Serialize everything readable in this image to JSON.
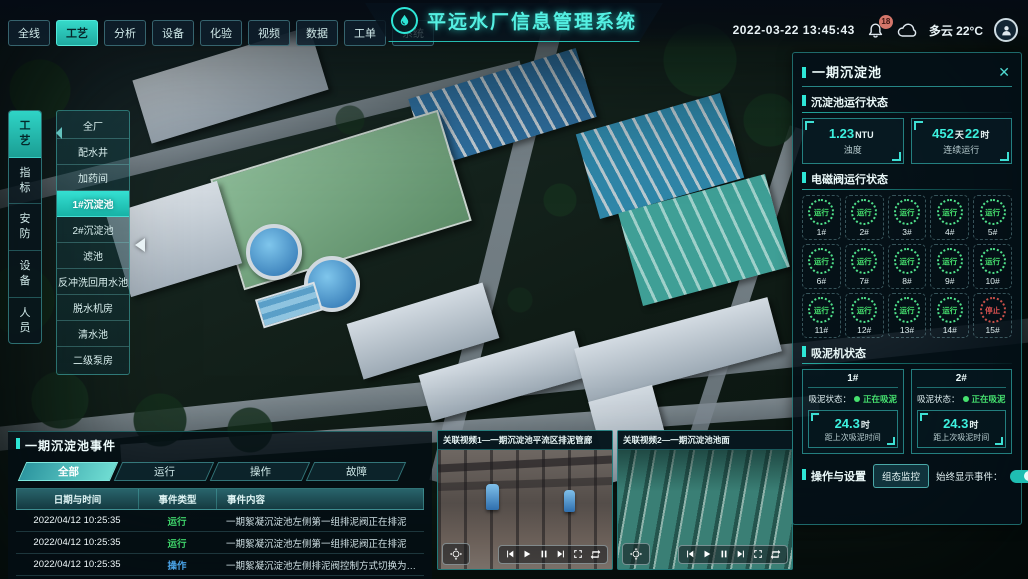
{
  "app": {
    "title": "平远水厂信息管理系统",
    "datetime": "2022-03-22 13:45:43",
    "notification_count": "18",
    "weather": "多云 22°C"
  },
  "nav_tabs": [
    {
      "label": "全线",
      "state": ""
    },
    {
      "label": "工艺",
      "state": "active"
    },
    {
      "label": "分析",
      "state": ""
    },
    {
      "label": "设备",
      "state": ""
    },
    {
      "label": "化验",
      "state": ""
    },
    {
      "label": "视频",
      "state": ""
    },
    {
      "label": "数据",
      "state": ""
    },
    {
      "label": "工单",
      "state": ""
    },
    {
      "label": "系统",
      "state": ""
    }
  ],
  "side_tabs": [
    {
      "label": "工艺",
      "state": "active"
    },
    {
      "label": "指标",
      "state": ""
    },
    {
      "label": "安防",
      "state": ""
    },
    {
      "label": "设备",
      "state": ""
    },
    {
      "label": "人员",
      "state": ""
    }
  ],
  "process_menu": [
    {
      "label": "全厂",
      "state": ""
    },
    {
      "label": "配水井",
      "state": ""
    },
    {
      "label": "加药间",
      "state": ""
    },
    {
      "label": "1#沉淀池",
      "state": "active"
    },
    {
      "label": "2#沉淀池",
      "state": ""
    },
    {
      "label": "滤池",
      "state": ""
    },
    {
      "label": "反冲洗回用水池",
      "state": ""
    },
    {
      "label": "脱水机房",
      "state": ""
    },
    {
      "label": "清水池",
      "state": ""
    },
    {
      "label": "二级泵房",
      "state": ""
    }
  ],
  "right_panel": {
    "title": "一期沉淀池",
    "run_status": {
      "title": "沉淀池运行状态",
      "stats": [
        {
          "value": "1.23",
          "unit": "NTU",
          "label": "浊度"
        },
        {
          "value": "452",
          "unit": "天",
          "value2": "22",
          "unit2": "时",
          "label": "连续运行"
        }
      ]
    },
    "valves": {
      "title": "电磁阀运行状态",
      "items": [
        {
          "id": "1#",
          "status": "运行",
          "state": "run"
        },
        {
          "id": "2#",
          "status": "运行",
          "state": "run"
        },
        {
          "id": "3#",
          "status": "运行",
          "state": "run"
        },
        {
          "id": "4#",
          "status": "运行",
          "state": "run"
        },
        {
          "id": "5#",
          "status": "运行",
          "state": "run"
        },
        {
          "id": "6#",
          "status": "运行",
          "state": "run"
        },
        {
          "id": "7#",
          "status": "运行",
          "state": "run"
        },
        {
          "id": "8#",
          "status": "运行",
          "state": "run"
        },
        {
          "id": "9#",
          "status": "运行",
          "state": "run"
        },
        {
          "id": "10#",
          "status": "运行",
          "state": "run"
        },
        {
          "id": "11#",
          "status": "运行",
          "state": "run"
        },
        {
          "id": "12#",
          "status": "运行",
          "state": "run"
        },
        {
          "id": "13#",
          "status": "运行",
          "state": "run"
        },
        {
          "id": "14#",
          "status": "运行",
          "state": "run"
        },
        {
          "id": "15#",
          "status": "停止",
          "state": "stop"
        }
      ]
    },
    "mud": {
      "title": "吸泥机状态",
      "status_label": "吸泥状态：",
      "items": [
        {
          "id": "1#",
          "status": "正在吸泥",
          "value": "24.3",
          "unit": "时",
          "label": "距上次吸泥时间"
        },
        {
          "id": "2#",
          "status": "正在吸泥",
          "value": "24.3",
          "unit": "时",
          "label": "距上次吸泥时间"
        }
      ]
    },
    "operations": {
      "title": "操作与设置",
      "monitor_button": "组态监控",
      "toggle_label": "始终显示事件：",
      "toggle_on": true
    }
  },
  "events": {
    "title": "一期沉淀池事件",
    "tabs": [
      {
        "label": "全部",
        "state": "active"
      },
      {
        "label": "运行",
        "state": ""
      },
      {
        "label": "操作",
        "state": ""
      },
      {
        "label": "故障",
        "state": ""
      }
    ],
    "columns": [
      "日期与时间",
      "事件类型",
      "事件内容"
    ],
    "rows": [
      {
        "time": "2022/04/12 10:25:35",
        "type": "运行",
        "type_class": "run",
        "content": "一期絮凝沉淀池左侧第一组排泥阀正在排泥"
      },
      {
        "time": "2022/04/12 10:25:35",
        "type": "运行",
        "type_class": "run",
        "content": "一期絮凝沉淀池左侧第一组排泥阀正在排泥"
      },
      {
        "time": "2022/04/12 10:25:35",
        "type": "操作",
        "type_class": "op",
        "content": "一期絮凝沉淀池左侧排泥阀控制方式切换为手动"
      },
      {
        "time": "2022/04/12 10:25:35",
        "type": "故障",
        "type_class": "fault",
        "content": "一期絮凝沉淀池左侧第二组排泥阀启动失败"
      }
    ]
  },
  "videos": {
    "items": [
      {
        "title": "关联视频1—一期沉淀池平流区排泥管廊"
      },
      {
        "title": "关联视频2—一期沉淀池池面"
      }
    ],
    "control_icons": [
      "pan-icon",
      "skip-back-icon",
      "play-icon",
      "pause-icon",
      "skip-forward-icon",
      "fullscreen-icon",
      "loop-icon"
    ]
  },
  "colors": {
    "accent": "#2ee6d6",
    "run": "#46e26f",
    "stop": "#e05252",
    "operate": "#4aa3e8",
    "fault_bg": "#7e2a1f"
  }
}
